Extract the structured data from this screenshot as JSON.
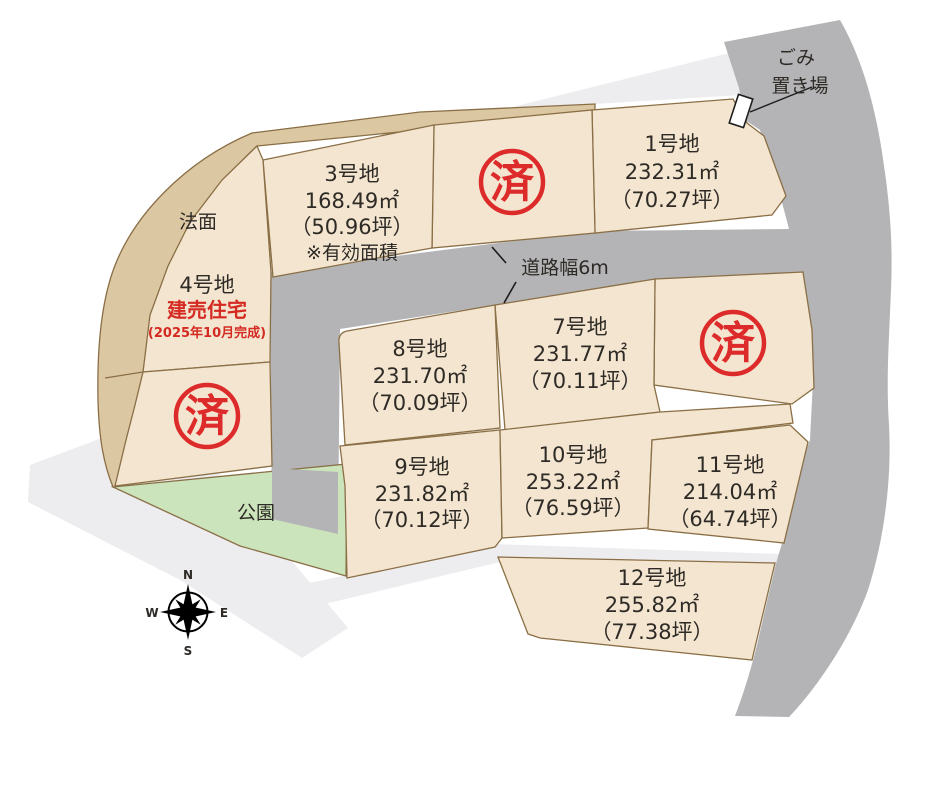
{
  "colors": {
    "background": "#ffffff",
    "plot_fill": "#f3e5cf",
    "slope_fill": "#dbc7a2",
    "park_fill": "#cbe4bb",
    "road_fill": "#b4b4b6",
    "path_fill": "#ededf0",
    "border": "#8a6f46",
    "stamp_red": "#dd2b2b",
    "accent_red": "#d42a22",
    "text": "#2e2a26"
  },
  "labels": {
    "garbage_line1": "ごみ",
    "garbage_line2": "置き場",
    "slope": "法面",
    "park": "公園",
    "road_width": "道路幅6m",
    "sold_stamp": "済",
    "compass": {
      "n": "N",
      "e": "E",
      "s": "S",
      "w": "W"
    }
  },
  "plots": [
    {
      "key": "1",
      "name": "1号地",
      "area_m2": "232.31㎡",
      "area_tsubo": "（70.27坪）"
    },
    {
      "key": "3",
      "name": "3号地",
      "area_m2": "168.49㎡",
      "area_tsubo": "（50.96坪）",
      "note": "※有効面積"
    },
    {
      "key": "4",
      "name": "4号地",
      "status": "建売住宅",
      "status_note": "(2025年10月完成)"
    },
    {
      "key": "7",
      "name": "7号地",
      "area_m2": "231.77㎡",
      "area_tsubo": "（70.11坪）"
    },
    {
      "key": "8",
      "name": "8号地",
      "area_m2": "231.70㎡",
      "area_tsubo": "（70.09坪）"
    },
    {
      "key": "9",
      "name": "9号地",
      "area_m2": "231.82㎡",
      "area_tsubo": "（70.12坪）"
    },
    {
      "key": "10",
      "name": "10号地",
      "area_m2": "253.22㎡",
      "area_tsubo": "（76.59坪）"
    },
    {
      "key": "11",
      "name": "11号地",
      "area_m2": "214.04㎡",
      "area_tsubo": "（64.74坪）"
    },
    {
      "key": "12",
      "name": "12号地",
      "area_m2": "255.82㎡",
      "area_tsubo": "（77.38坪）"
    }
  ]
}
